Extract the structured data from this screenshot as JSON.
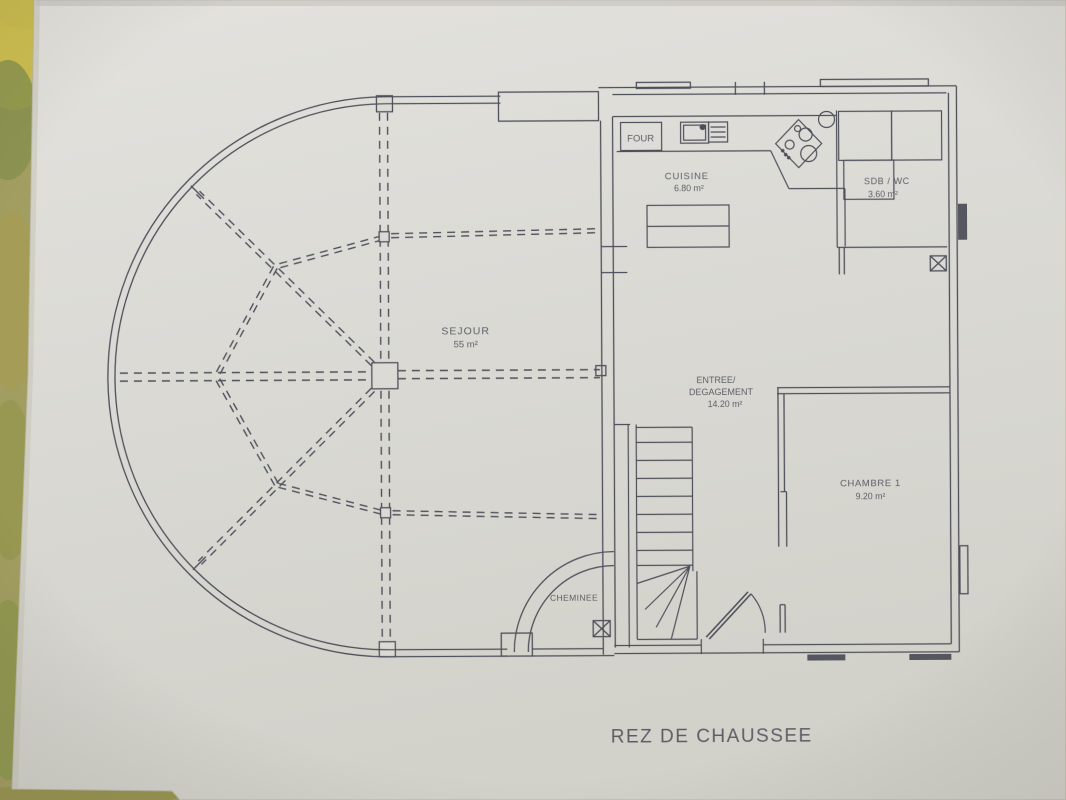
{
  "plan": {
    "title": "REZ DE CHAUSSEE",
    "rooms": [
      {
        "name": "SEJOUR",
        "area": "55 m²"
      },
      {
        "name": "CUISINE",
        "area": "6.80 m²"
      },
      {
        "name": "SDB / WC",
        "area": "3.60 m²"
      },
      {
        "name_line1": "ENTREE/",
        "name_line2": "DEGAGEMENT",
        "area": "14.20 m²"
      },
      {
        "name": "CHAMBRE 1",
        "area": "9.20 m²"
      }
    ],
    "features": {
      "four": "FOUR",
      "cheminee": "CHEMINEE"
    }
  },
  "colors": {
    "ink": "#4e4f5a",
    "paper": "#dbdad5",
    "table": "#9c9a5e"
  }
}
